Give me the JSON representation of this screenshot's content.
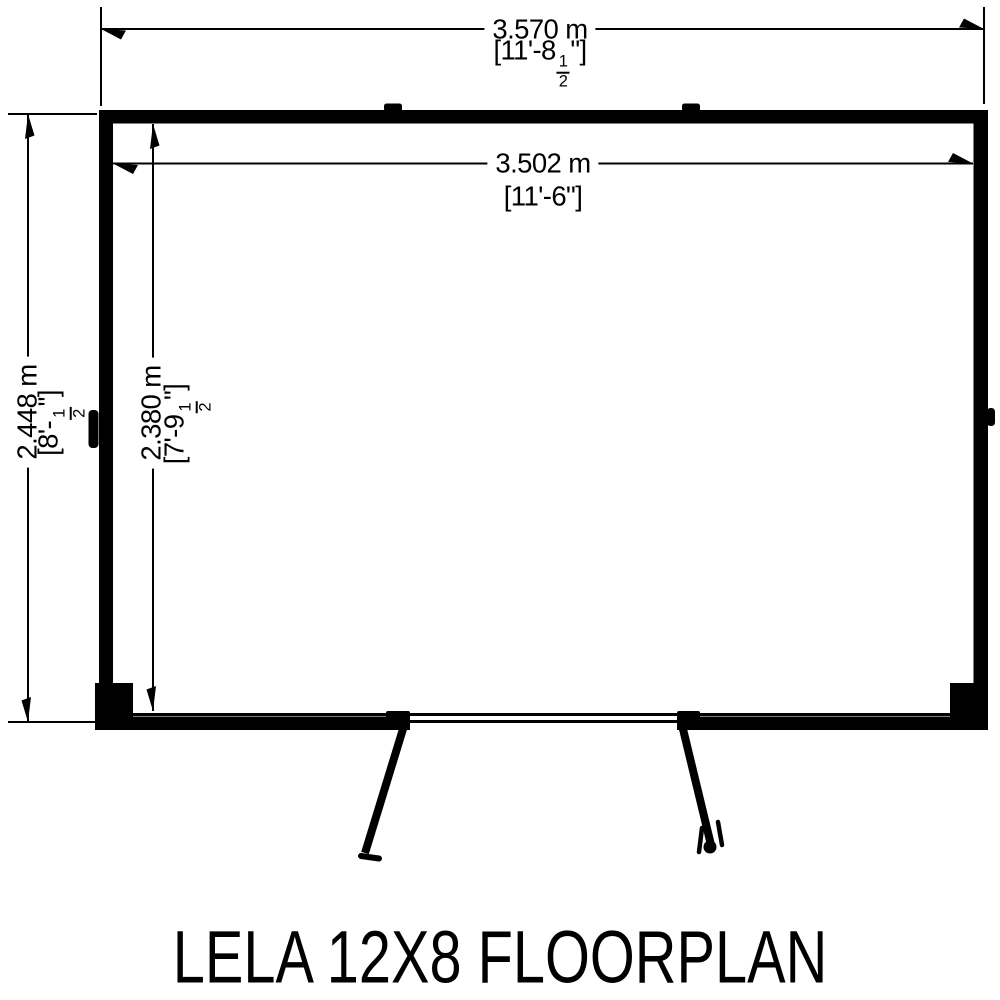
{
  "title": "LELA 12X8 FLOORPLAN",
  "colors": {
    "ink": "#000000",
    "background": "#ffffff"
  },
  "dimensions": {
    "outer_width": {
      "metric": "3.570 m",
      "imperial_prefix": "[11'-8",
      "imperial_num": "1",
      "imperial_den": "2",
      "imperial_suffix": "\"]"
    },
    "inner_width": {
      "metric": "3.502 m",
      "imperial": "[11'-6\"]"
    },
    "outer_depth": {
      "metric": "2.448 m",
      "imperial_prefix": "[8'-",
      "imperial_num": "1",
      "imperial_den": "2",
      "imperial_suffix": "\"]"
    },
    "inner_depth": {
      "metric": "2.380 m",
      "imperial_prefix": "[7'-9",
      "imperial_num": "1",
      "imperial_den": "2",
      "imperial_suffix": "\"]"
    }
  }
}
